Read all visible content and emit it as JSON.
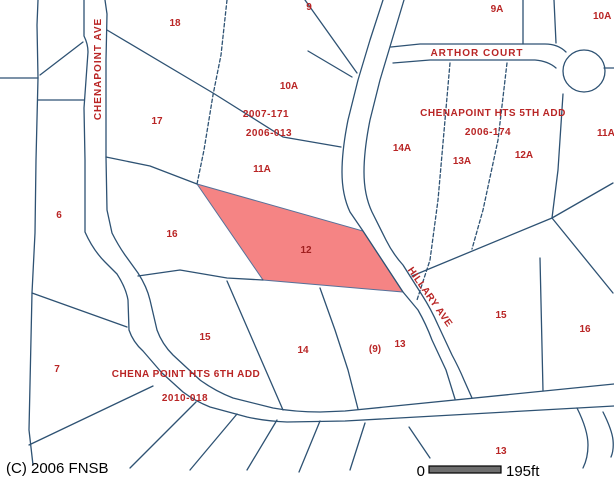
{
  "map_type": "parcel-plat-map",
  "colors": {
    "boundary_line": "#2e5273",
    "label_red": "#b92525",
    "highlight_fill": "#f58484",
    "scale_bar_fill": "#6e6e6e"
  },
  "streets": {
    "chenapoint_ave": "CHENAPOINT AVE",
    "arthor_court": "ARTHOR COURT",
    "hillary_ave": "HILLARY AVE"
  },
  "subdivisions": {
    "fifth": {
      "name": "CHENAPOINT HTS 5TH ADD",
      "plat": "2006-174"
    },
    "sixth": {
      "name": "CHENA POINT HTS 6TH ADD",
      "plat": "2010-018"
    }
  },
  "plats": {
    "p2007_171": "2007-171",
    "p2006_013": "2006-013"
  },
  "parcels": {
    "p18": "18",
    "p9": "9",
    "p9a": "9A",
    "p10a_edge": "10A",
    "p10a": "10A",
    "p17": "17",
    "p11a": "11A",
    "p6": "6",
    "p16_left": "16",
    "p14a": "14A",
    "p13a": "13A",
    "p12a": "12A",
    "p11_edge": "11A",
    "p15_left": "15",
    "p14": "14",
    "p7": "7",
    "p9_paren": "(9)",
    "p13_mid": "13",
    "p15_right": "15",
    "p16_right": "16",
    "p13_bottom": "13"
  },
  "highlight": {
    "parcel_label": "12",
    "fill": "#f58484"
  },
  "footer": {
    "copyright": "(C) 2006 FNSB"
  },
  "scale_bar": {
    "zero": "0",
    "distance": "195ft"
  }
}
